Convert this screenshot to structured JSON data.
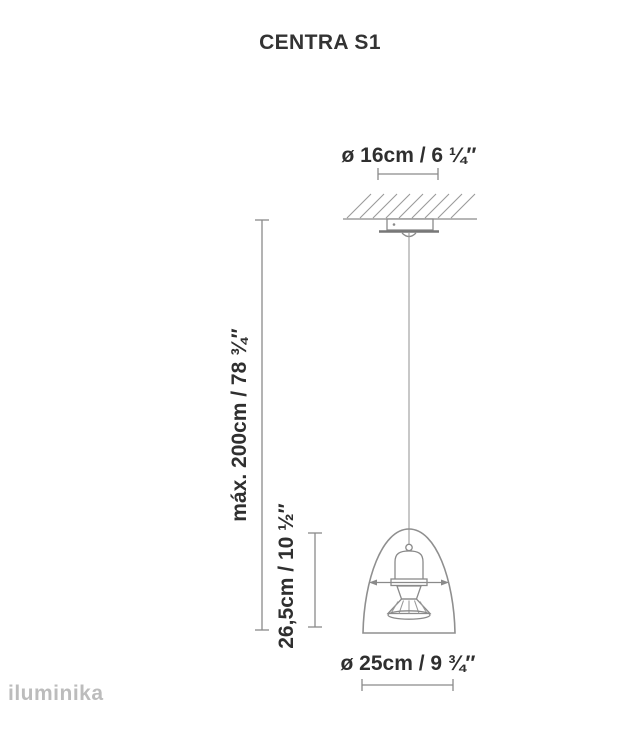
{
  "title": "CENTRA S1",
  "diagram": {
    "canopy_diameter_label": "ø 16cm / 6 ¼″",
    "max_height_label": "máx. 200cm / 78 ¾″",
    "shade_height_label": "26,5cm / 10 ½″",
    "shade_diameter_label": "ø 25cm / 9 ¾″"
  },
  "watermark": "iluminika",
  "colors": {
    "line": "#8a8a8a",
    "text": "#2f2f2f",
    "title": "#333333",
    "watermark": "#bcbcbc",
    "background": "#ffffff"
  }
}
